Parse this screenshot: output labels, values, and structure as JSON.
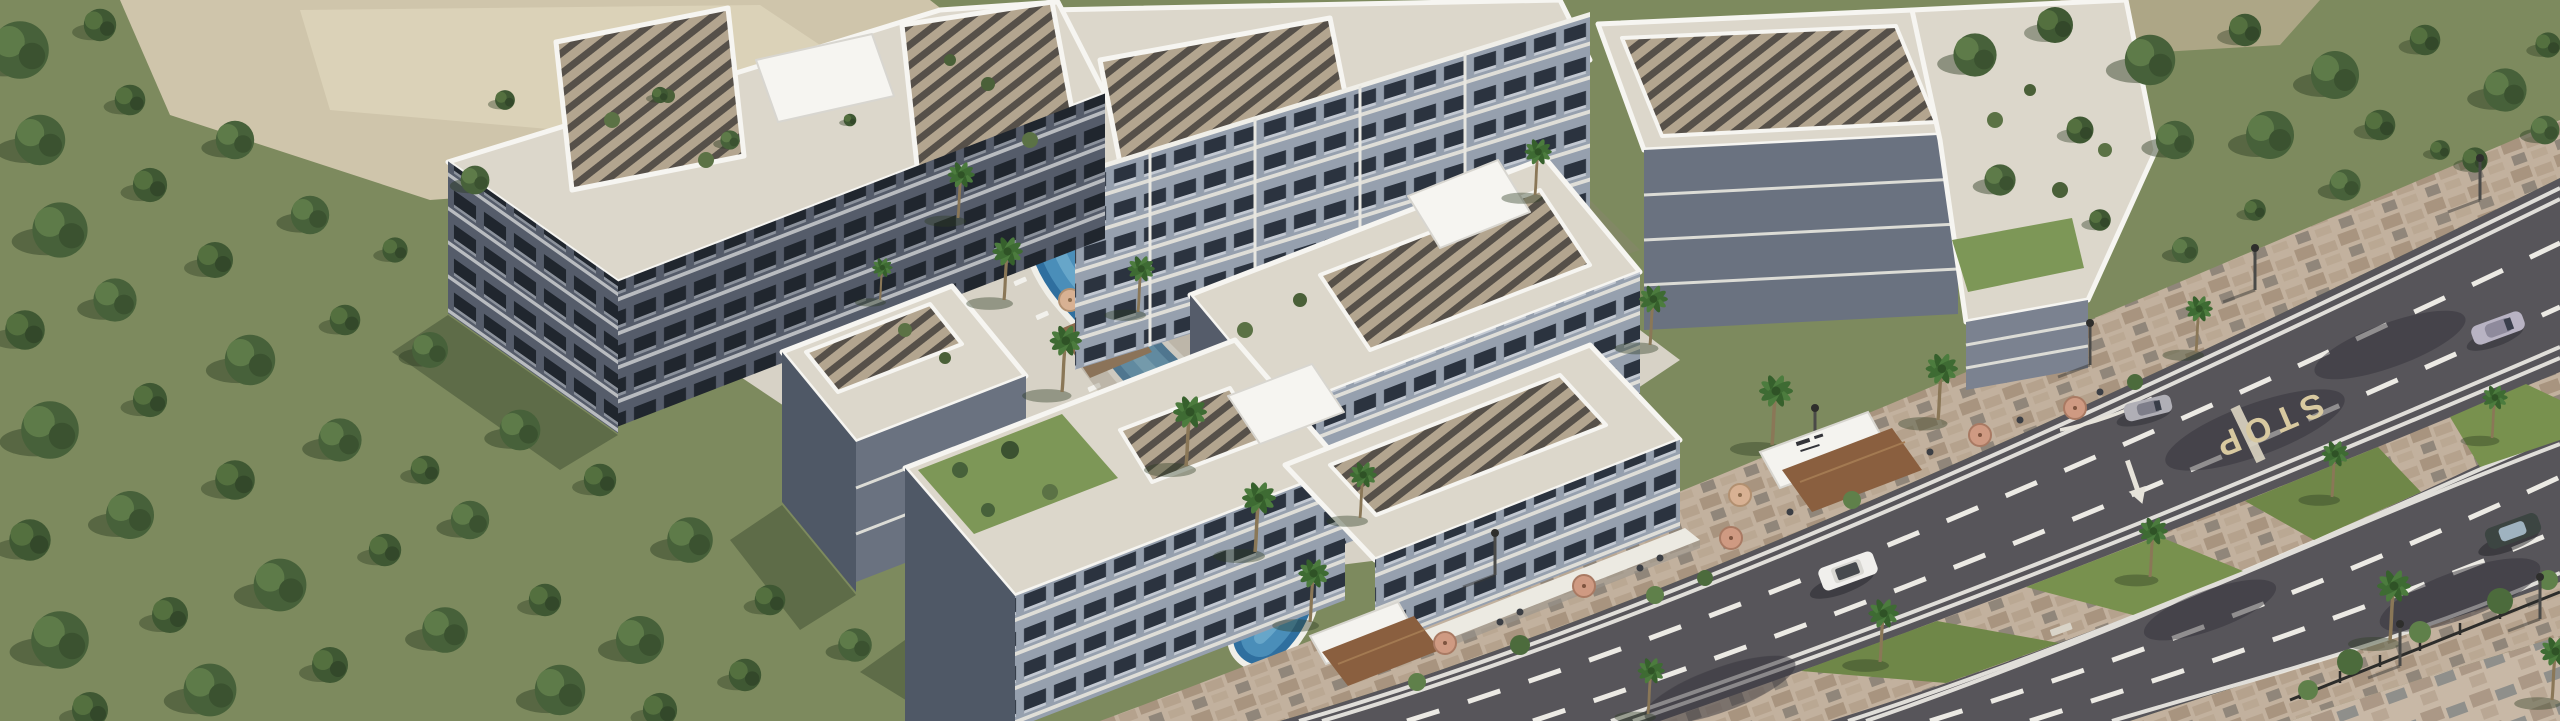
{
  "image": {
    "type": "3D architectural aerial rendering",
    "description": "Daytime bird's-eye render of a modern white low-rise residential complex with slatted pergola roofs, roof terraces and a winding courtyard swimming pool, bordered by dense woodland on the left and a landscaped dual-carriageway road with a palm-lined median at the lower right.",
    "time_of_day": "day",
    "style": "photorealistic marketing render"
  },
  "road": {
    "marking_text": "STOP",
    "lane_markings": "white dashed lane lines with double solid edge lines and a lane direction arrow",
    "median": "paved median island with grass beds, palm trees and street lamps",
    "vehicles": [
      {
        "name": "silver coupe",
        "color_hex": "#b8b3c3",
        "location": "upper carriageway, top right"
      },
      {
        "name": "silver car turning at complex entrance",
        "color_hex": "#b0afb6",
        "location": "upper carriageway, centre right"
      },
      {
        "name": "white SUV",
        "color_hex": "#f0efec",
        "location": "upper carriageway, centre"
      },
      {
        "name": "dark sedan",
        "color_hex": "#3c4542",
        "location": "lower carriageway, bottom right"
      }
    ],
    "street_furniture": [
      "street lamps",
      "pedestrian railing",
      "paved sidewalks",
      "kerbside shrubs"
    ]
  },
  "complex": {
    "buildings": "white 4–5 storey apartment blocks arranged around landscaped courtyards",
    "roofs": [
      "slatted timber pergola canopies",
      "beige roof terraces with potted trees",
      "white penthouse volumes",
      "green roof garden"
    ],
    "amenities": [
      "winding courtyard swimming pool",
      "small plunge pool",
      "sun loungers",
      "timber pool decks",
      "palm trees",
      "street-front cafe with umbrellas",
      "entrance pavilions with brown canopies and logo sign"
    ],
    "logo_sign": "illegible developer logo on white entrance wall"
  },
  "landscape": {
    "left": "dense green woodland",
    "top_left": "sandy clearing",
    "top_right": "woodland strip beside the road",
    "bottom_right": "paved pedestrian plaza with shrubs, railing and palms"
  },
  "colors": {
    "ground": "#7d8a5e",
    "sand": "#cfc5ab",
    "asphalt": "#57555a",
    "pool_water": "#2f6f9f",
    "pool_water_light": "#5498c2",
    "median_grass": "#6f8748",
    "stop_text": "#d8c9a0",
    "canopy_brown": "#8a5f3f",
    "terrace": "#dcd7cb",
    "parapet": "#f6f5f1",
    "facade_light": "#96a0ae",
    "facade_dark": "#555c6a",
    "paver": "#c2b19e",
    "foliage": "#47613a"
  }
}
